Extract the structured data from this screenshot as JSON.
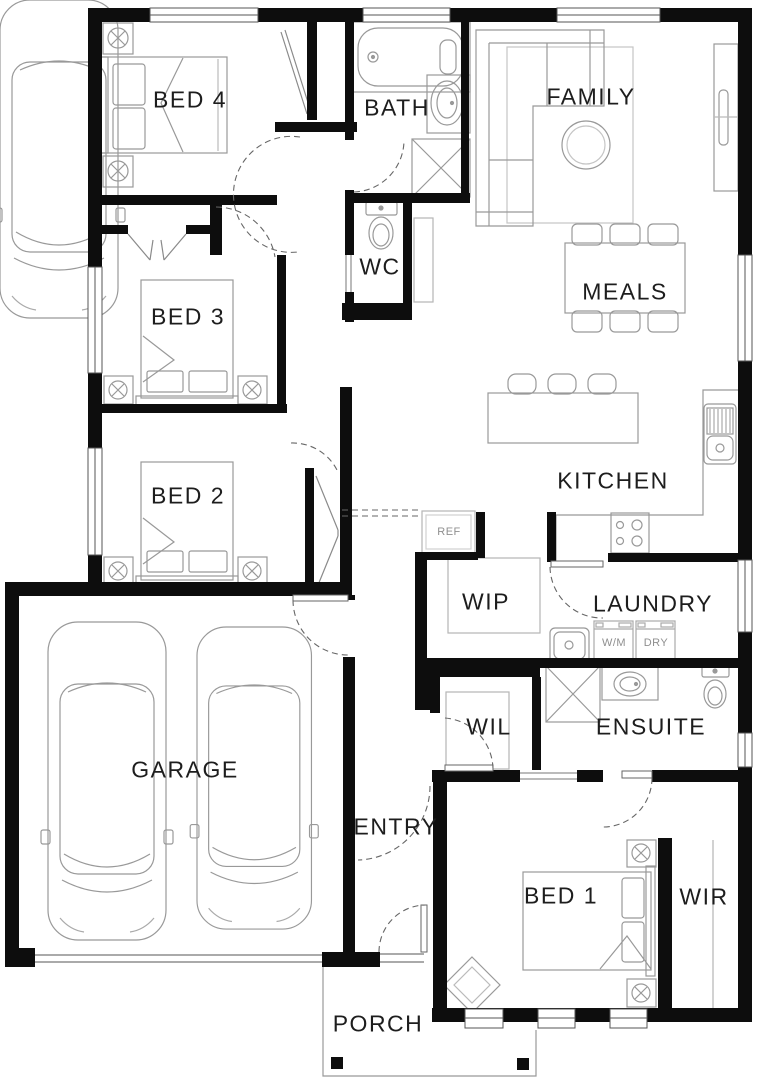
{
  "rooms": {
    "bed4": {
      "label": "BED 4"
    },
    "bath": {
      "label": "BATH"
    },
    "family": {
      "label": "FAMILY"
    },
    "wc": {
      "label": "WC"
    },
    "bed3": {
      "label": "BED 3"
    },
    "meals": {
      "label": "MEALS"
    },
    "kitchen": {
      "label": "KITCHEN"
    },
    "bed2": {
      "label": "BED 2"
    },
    "wip": {
      "label": "WIP"
    },
    "laundry": {
      "label": "LAUNDRY"
    },
    "garage": {
      "label": "GARAGE"
    },
    "wil": {
      "label": "WIL"
    },
    "ensuite": {
      "label": "ENSUITE"
    },
    "entry": {
      "label": "ENTRY"
    },
    "bed1": {
      "label": "BED 1"
    },
    "wir": {
      "label": "WIR"
    },
    "porch": {
      "label": "PORCH"
    }
  },
  "appliances": {
    "fridge": "REF",
    "washer": "W/M",
    "dryer": "DRY"
  },
  "colors": {
    "wall": "#0d0d0d",
    "furniture": "#999999",
    "background": "#ffffff"
  }
}
